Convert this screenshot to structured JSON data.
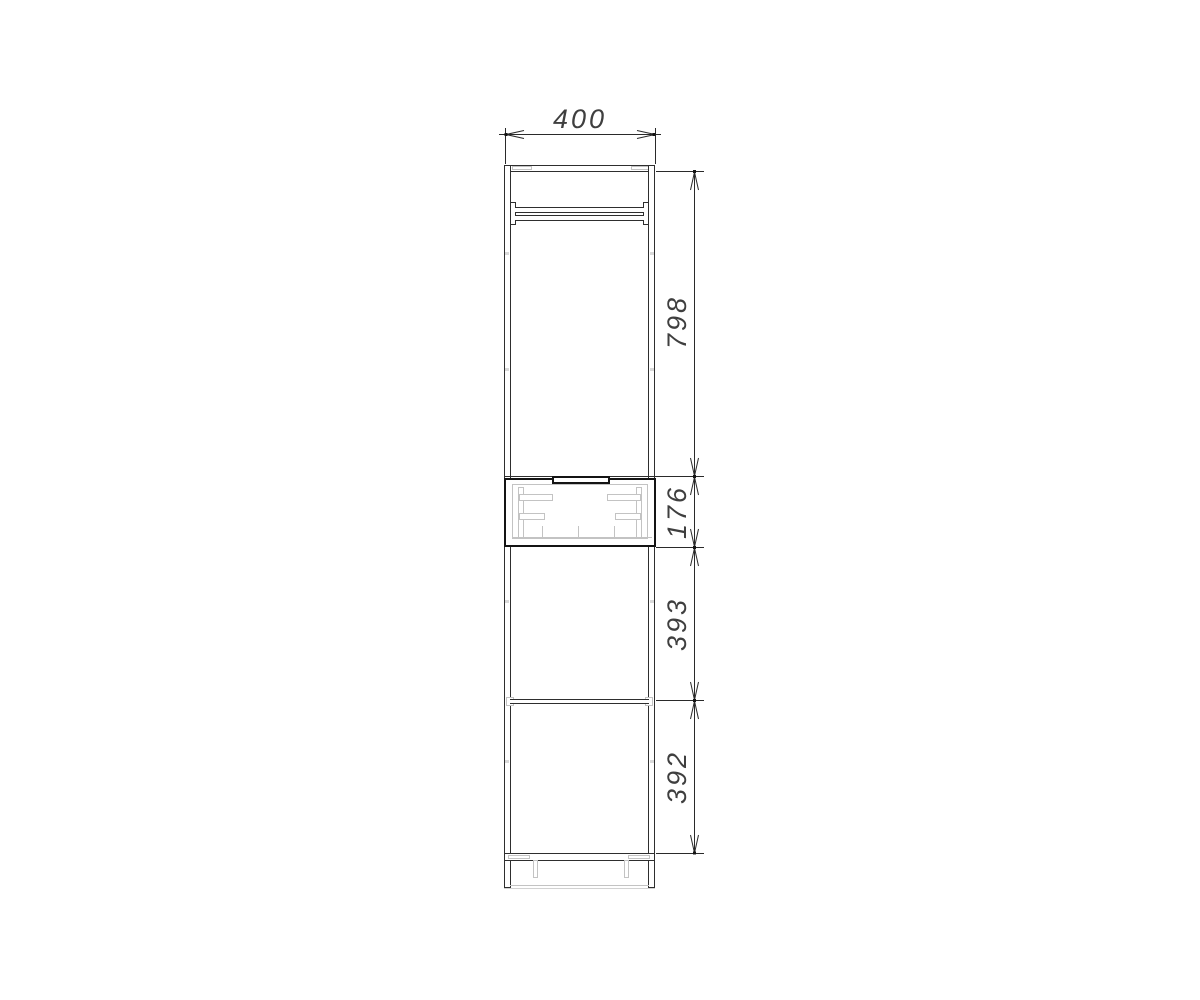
{
  "drawing_type": "cabinet-front-elevation",
  "colors": {
    "background": "#ffffff",
    "line": "#2e2e2e",
    "bold_line": "#141414",
    "light_line": "#c3c3c3",
    "dimension_text": "#3f3f3f"
  },
  "dimensions": {
    "width": {
      "label": "400",
      "orientation": "horizontal"
    },
    "heights": [
      {
        "label": "798",
        "orientation": "vertical"
      },
      {
        "label": "176",
        "orientation": "vertical"
      },
      {
        "label": "393",
        "orientation": "vertical"
      },
      {
        "label": "392",
        "orientation": "vertical"
      }
    ]
  }
}
